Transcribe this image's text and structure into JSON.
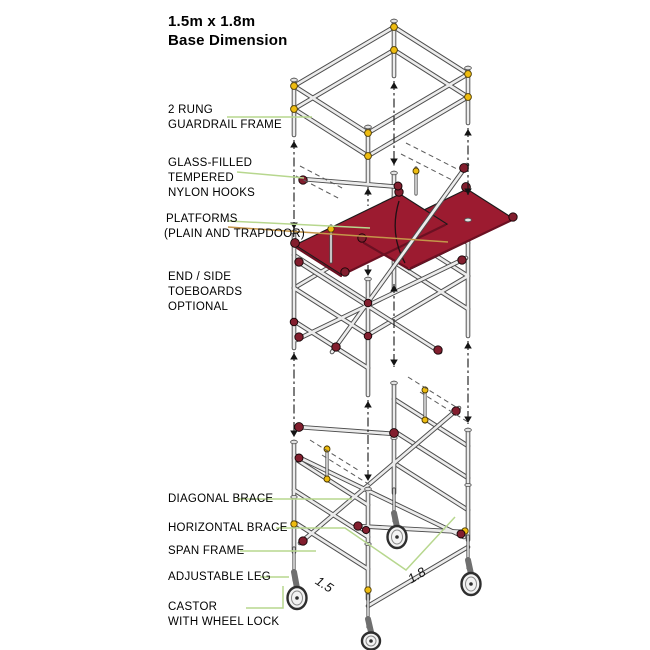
{
  "colors": {
    "platform_red": "#9C1B30",
    "clamp_yellow": "#EEBC10",
    "hook_maroon": "#821E2E",
    "leader_green": "#B7D78E",
    "leader_tan": "#C4964A",
    "tube_fill": "#ECECEC",
    "tube_outline": "#4D4D4D"
  },
  "title": {
    "line1": "1.5m x 1.8m",
    "line2": "Base Dimension"
  },
  "labels": {
    "rung_guardrail": {
      "lines": [
        "2 RUNG",
        "GUARDRAIL FRAME"
      ]
    },
    "nylon_hooks": {
      "lines": [
        "GLASS-FILLED",
        "TEMPERED",
        "NYLON HOOKS"
      ]
    },
    "platforms": {
      "lines": [
        "PLATFORMS",
        "(PLAIN AND TRAPDOOR)"
      ]
    },
    "toeboards": {
      "lines": [
        "END / SIDE",
        "TOEBOARDS",
        "OPTIONAL"
      ]
    },
    "diagonal_brace": {
      "lines": [
        "DIAGONAL BRACE"
      ]
    },
    "horizontal_brace": {
      "lines": [
        "HORIZONTAL BRACE"
      ]
    },
    "span_frame": {
      "lines": [
        "SPAN FRAME"
      ]
    },
    "adjustable_leg": {
      "lines": [
        "ADJUSTABLE LEG"
      ]
    },
    "castor": {
      "lines": [
        "CASTOR",
        "WITH WHEEL LOCK"
      ]
    }
  },
  "dimensions": {
    "width_m": "1.5",
    "depth_m": "1.8"
  }
}
